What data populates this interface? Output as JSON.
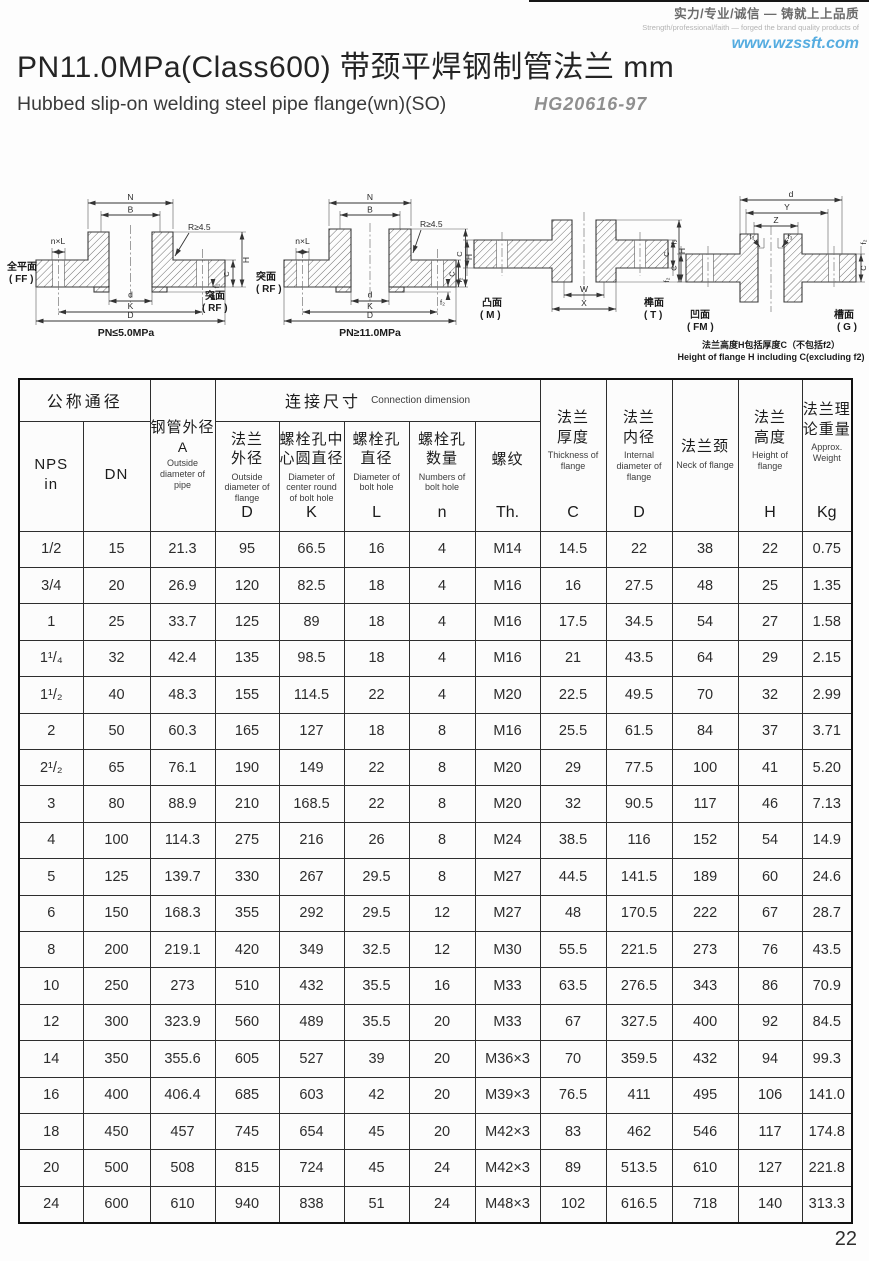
{
  "brand": {
    "line_zh": "实力/专业/诚信 — 铸就上上品质",
    "line_en": "Strength/professional/faith — forged the brand quality products of",
    "website": "www.wzssft.com"
  },
  "title": {
    "main": "PN11.0MPa(Class600) 带颈平焊钢制管法兰 mm",
    "sub_en": "Hubbed slip-on welding steel pipe flange(wn)(SO)",
    "standard": "HG20616-97"
  },
  "diagrams": {
    "d1": {
      "dim_n": "N",
      "dim_b": "B",
      "dim_nl": "n×L",
      "dim_r": "R≥4.5",
      "dim_d": "d",
      "dim_k": "K",
      "dim_dd": "D",
      "dim_h": "H",
      "dim_c": "C",
      "dim_f": "f₁",
      "face_left_zh": "全平面",
      "face_left_en": "( FF )",
      "face_right_zh": "突面",
      "face_right_en": "( RF )",
      "caption": "PN≤5.0MPa"
    },
    "d2": {
      "dim_n": "N",
      "dim_b": "B",
      "dim_nl": "n×L",
      "dim_r": "R≥4.5",
      "dim_d": "d",
      "dim_k": "K",
      "dim_dd": "D",
      "dim_h": "H",
      "dim_c": "C",
      "dim_f": "f₂",
      "face_left_zh": "突面",
      "face_left_en": "( RF )",
      "caption": "PN≥11.0MPa"
    },
    "d3": {
      "dim_w": "W",
      "dim_x": "X",
      "dim_c": "C",
      "dim_h": "H",
      "dim_f": "f₂",
      "face_left_zh": "凸面",
      "face_left_en": "( M )",
      "face_right_zh": "榫面",
      "face_right_en": "( T )"
    },
    "d4": {
      "dim_d": "d",
      "dim_y": "Y",
      "dim_z": "Z",
      "dim_f3": "f₃",
      "dim_f2": "f₂",
      "dim_c": "C",
      "face_left_zh": "凹面",
      "face_left_en": "( FM )",
      "face_right_zh": "槽面",
      "face_right_en": "( G )",
      "caption_zh": "法兰高度H包括厚度C（不包括f2）",
      "caption_en": "Height of flange H including C(excluding f2)"
    }
  },
  "table": {
    "group_nominal": "公称通径",
    "group_connection_zh": "连接尺寸",
    "group_connection_en": "Connection dimension",
    "columns": [
      {
        "zh": "NPS\nin",
        "en": "",
        "letter": ""
      },
      {
        "zh": "DN",
        "en": "",
        "letter": ""
      },
      {
        "zh": "钢管外径",
        "mid": "A",
        "en": "Outside diameter of pipe",
        "letter": ""
      },
      {
        "zh": "法兰\n外径",
        "en": "Outside diameter of flange",
        "letter": "D"
      },
      {
        "zh": "螺栓孔中\n心圆直径",
        "en": "Diameter of center round of bolt hole",
        "letter": "K"
      },
      {
        "zh": "螺栓孔\n直径",
        "en": "Diameter of bolt hole",
        "letter": "L"
      },
      {
        "zh": "螺栓孔\n数量",
        "en": "Numbers of bolt hole",
        "letter": "n"
      },
      {
        "zh": "螺纹",
        "en": "",
        "letter": "Th."
      },
      {
        "zh": "法兰\n厚度",
        "en": "Thickness of flange",
        "letter": "C"
      },
      {
        "zh": "法兰\n内径",
        "en": "Internal diameter of flange",
        "letter": "D"
      },
      {
        "zh": "法兰颈",
        "en": "Neck of flange",
        "letter": ""
      },
      {
        "zh": "法兰\n高度",
        "en": "Height of flange",
        "letter": "H"
      },
      {
        "zh": "法兰理\n论重量",
        "en": "Approx. Weight",
        "letter": "Kg"
      }
    ],
    "rows": [
      [
        "1/2",
        "15",
        "21.3",
        "95",
        "66.5",
        "16",
        "4",
        "M14",
        "14.5",
        "22",
        "38",
        "22",
        "0.75"
      ],
      [
        "3/4",
        "20",
        "26.9",
        "120",
        "82.5",
        "18",
        "4",
        "M16",
        "16",
        "27.5",
        "48",
        "25",
        "1.35"
      ],
      [
        "1",
        "25",
        "33.7",
        "125",
        "89",
        "18",
        "4",
        "M16",
        "17.5",
        "34.5",
        "54",
        "27",
        "1.58"
      ],
      [
        "1¹/₄",
        "32",
        "42.4",
        "135",
        "98.5",
        "18",
        "4",
        "M16",
        "21",
        "43.5",
        "64",
        "29",
        "2.15"
      ],
      [
        "1¹/₂",
        "40",
        "48.3",
        "155",
        "114.5",
        "22",
        "4",
        "M20",
        "22.5",
        "49.5",
        "70",
        "32",
        "2.99"
      ],
      [
        "2",
        "50",
        "60.3",
        "165",
        "127",
        "18",
        "8",
        "M16",
        "25.5",
        "61.5",
        "84",
        "37",
        "3.71"
      ],
      [
        "2¹/₂",
        "65",
        "76.1",
        "190",
        "149",
        "22",
        "8",
        "M20",
        "29",
        "77.5",
        "100",
        "41",
        "5.20"
      ],
      [
        "3",
        "80",
        "88.9",
        "210",
        "168.5",
        "22",
        "8",
        "M20",
        "32",
        "90.5",
        "117",
        "46",
        "7.13"
      ],
      [
        "4",
        "100",
        "114.3",
        "275",
        "216",
        "26",
        "8",
        "M24",
        "38.5",
        "116",
        "152",
        "54",
        "14.9"
      ],
      [
        "5",
        "125",
        "139.7",
        "330",
        "267",
        "29.5",
        "8",
        "M27",
        "44.5",
        "141.5",
        "189",
        "60",
        "24.6"
      ],
      [
        "6",
        "150",
        "168.3",
        "355",
        "292",
        "29.5",
        "12",
        "M27",
        "48",
        "170.5",
        "222",
        "67",
        "28.7"
      ],
      [
        "8",
        "200",
        "219.1",
        "420",
        "349",
        "32.5",
        "12",
        "M30",
        "55.5",
        "221.5",
        "273",
        "76",
        "43.5"
      ],
      [
        "10",
        "250",
        "273",
        "510",
        "432",
        "35.5",
        "16",
        "M33",
        "63.5",
        "276.5",
        "343",
        "86",
        "70.9"
      ],
      [
        "12",
        "300",
        "323.9",
        "560",
        "489",
        "35.5",
        "20",
        "M33",
        "67",
        "327.5",
        "400",
        "92",
        "84.5"
      ],
      [
        "14",
        "350",
        "355.6",
        "605",
        "527",
        "39",
        "20",
        "M36×3",
        "70",
        "359.5",
        "432",
        "94",
        "99.3"
      ],
      [
        "16",
        "400",
        "406.4",
        "685",
        "603",
        "42",
        "20",
        "M39×3",
        "76.5",
        "411",
        "495",
        "106",
        "141.0"
      ],
      [
        "18",
        "450",
        "457",
        "745",
        "654",
        "45",
        "20",
        "M42×3",
        "83",
        "462",
        "546",
        "117",
        "174.8"
      ],
      [
        "20",
        "500",
        "508",
        "815",
        "724",
        "45",
        "24",
        "M42×3",
        "89",
        "513.5",
        "610",
        "127",
        "221.8"
      ],
      [
        "24",
        "600",
        "610",
        "940",
        "838",
        "51",
        "24",
        "M48×3",
        "102",
        "616.5",
        "718",
        "140",
        "313.3"
      ]
    ]
  },
  "page_number": "22"
}
